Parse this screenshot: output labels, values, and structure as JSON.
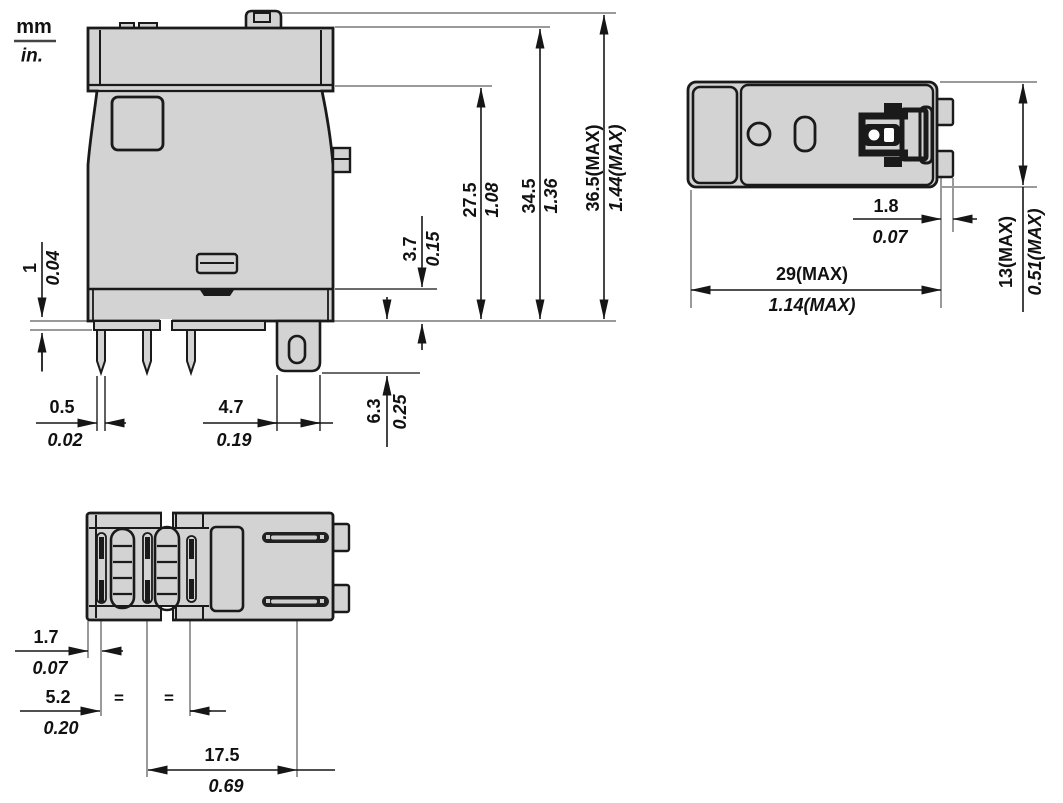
{
  "legend": {
    "mm": "mm",
    "inch": "in."
  },
  "colors": {
    "body_fill": "#d3d3d3",
    "outline": "#1a1a1a",
    "extension_line": "#9a9a9a",
    "dimension_line": "#161616"
  },
  "front_view": {
    "overall_height": {
      "mm": "36.5(MAX)",
      "inch": "1.44(MAX)"
    },
    "body_height": {
      "mm": "34.5",
      "inch": "1.36"
    },
    "cover_height": {
      "mm": "27.5",
      "inch": "1.08"
    },
    "base_height": {
      "mm": "3.7",
      "inch": "0.15"
    },
    "standoff": {
      "mm": "1",
      "inch": "0.04"
    },
    "pin_thickness": {
      "mm": "0.5",
      "inch": "0.02"
    },
    "tab_width": {
      "mm": "4.7",
      "inch": "0.19"
    },
    "pin_length": {
      "mm": "6.3",
      "inch": "0.25"
    }
  },
  "top_view": {
    "tab_depth": {
      "mm": "1.8",
      "inch": "0.07"
    },
    "overall_width": {
      "mm": "29(MAX)",
      "inch": "1.14(MAX)"
    },
    "overall_depth": {
      "mm": "13(MAX)",
      "inch": "0.51(MAX)"
    }
  },
  "bottom_view": {
    "edge_to_pin": {
      "mm": "1.7",
      "inch": "0.07"
    },
    "pin_pitch": {
      "mm": "5.2",
      "inch": "0.20"
    },
    "pin_span": {
      "mm": "17.5",
      "inch": "0.69"
    },
    "equal_spacing_marks": [
      "=",
      "="
    ]
  }
}
